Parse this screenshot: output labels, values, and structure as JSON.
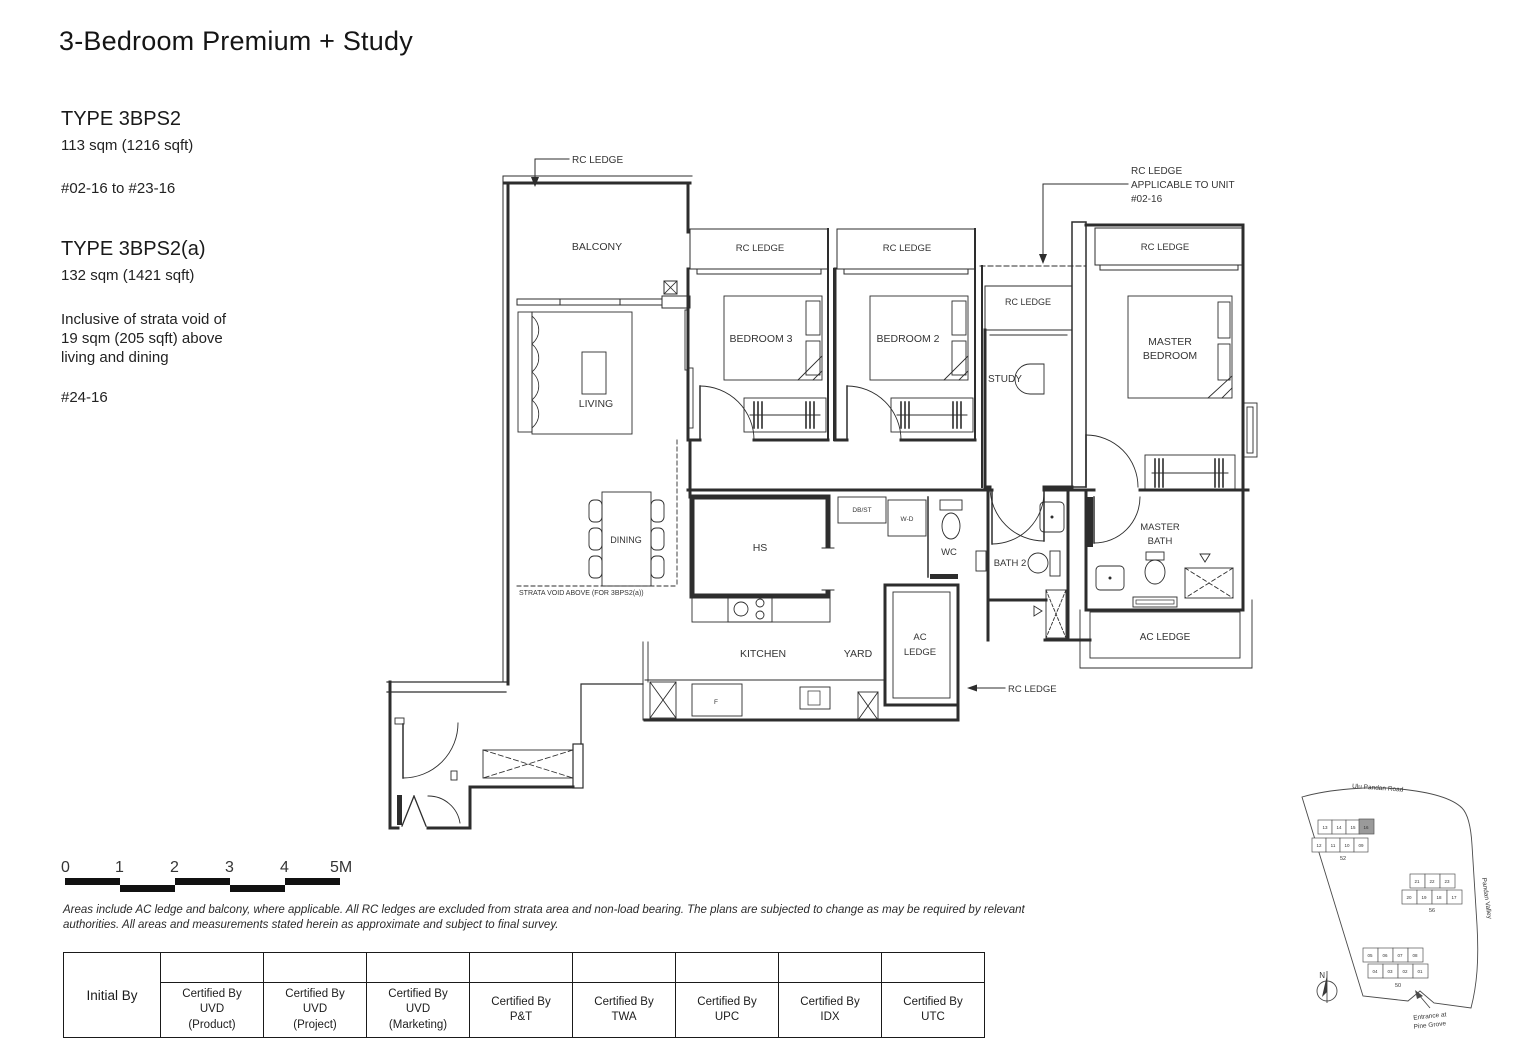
{
  "page": {
    "title": "3-Bedroom Premium + Study"
  },
  "types": [
    {
      "name": "TYPE 3BPS2",
      "area": "113 sqm (1216 sqft)",
      "units": "#02-16 to #23-16"
    },
    {
      "name": "TYPE 3BPS2(a)",
      "area": "132 sqm (1421 sqft)",
      "units": "#24-16"
    }
  ],
  "note_lines": [
    "Inclusive of strata void of",
    "19 sqm (205 sqft) above",
    "living and dining"
  ],
  "plan": {
    "rc_ledge": "RC LEDGE",
    "applicable_l1": "RC LEDGE",
    "applicable_l2": "APPLICABLE TO UNIT",
    "applicable_l3": "#02-16",
    "balcony": "BALCONY",
    "living": "LIVING",
    "dining": "DINING",
    "bedroom3": "BEDROOM 3",
    "bedroom2": "BEDROOM 2",
    "study": "STUDY",
    "master_l1": "MASTER",
    "master_l2": "BEDROOM",
    "hs": "HS",
    "db_st": "DB/ST",
    "wd": "W-D",
    "wc": "WC",
    "bath2": "BATH 2",
    "mbath_l1": "MASTER",
    "mbath_l2": "BATH",
    "kitchen": "KITCHEN",
    "yard": "YARD",
    "fridge": "F",
    "acledge_l1": "AC",
    "acledge_l2": "LEDGE",
    "acledge": "AC LEDGE",
    "strata": "STRATA VOID ABOVE (FOR 3BPS2(a))"
  },
  "scalebar": {
    "ticks": [
      "0",
      "1",
      "2",
      "3",
      "4",
      "5M"
    ]
  },
  "disclaimer": {
    "line1": "Areas include AC ledge and balcony, where applicable. All RC ledges are excluded from strata area and non-load bearing. The plans are subjected to change as may be required by relevant",
    "line2": "authorities. All areas and measurements stated herein as approximate and subject to final survey."
  },
  "table": {
    "initial_by": "Initial By",
    "columns": [
      {
        "lines": [
          "Certified By",
          "UVD",
          "(Product)"
        ]
      },
      {
        "lines": [
          "Certified By",
          "UVD",
          "(Project)"
        ]
      },
      {
        "lines": [
          "Certified By",
          "UVD",
          "(Marketing)"
        ]
      },
      {
        "lines": [
          "Certified By",
          "P&T"
        ]
      },
      {
        "lines": [
          "Certified By",
          "TWA"
        ]
      },
      {
        "lines": [
          "Certified By",
          "UPC"
        ]
      },
      {
        "lines": [
          "Certified By",
          "IDX"
        ]
      },
      {
        "lines": [
          "Certified By",
          "UTC"
        ]
      }
    ]
  },
  "sitemap": {
    "road_top": "Ulu Pandan Road",
    "road_right": "Pandan Valley",
    "entrance_l1": "Entrance at",
    "entrance_l2": "Pine Grove",
    "compass": "N",
    "clusters": [
      {
        "label": "52",
        "row1": [
          "13",
          "14",
          "15",
          "16"
        ],
        "row2": [
          "12",
          "11",
          "10",
          "09"
        ],
        "highlighted_stack": "16"
      },
      {
        "label": "56",
        "row1": [
          "21",
          "22",
          "23"
        ],
        "row2": [
          "20",
          "19",
          "18",
          "17"
        ]
      },
      {
        "label": "50",
        "row1": [
          "05",
          "06",
          "07",
          "08"
        ],
        "row2": [
          "04",
          "03",
          "02",
          "01"
        ]
      }
    ]
  },
  "colors": {
    "line": "#2d2d2d",
    "highlight_block": "#9a9a9a",
    "background": "#ffffff"
  }
}
